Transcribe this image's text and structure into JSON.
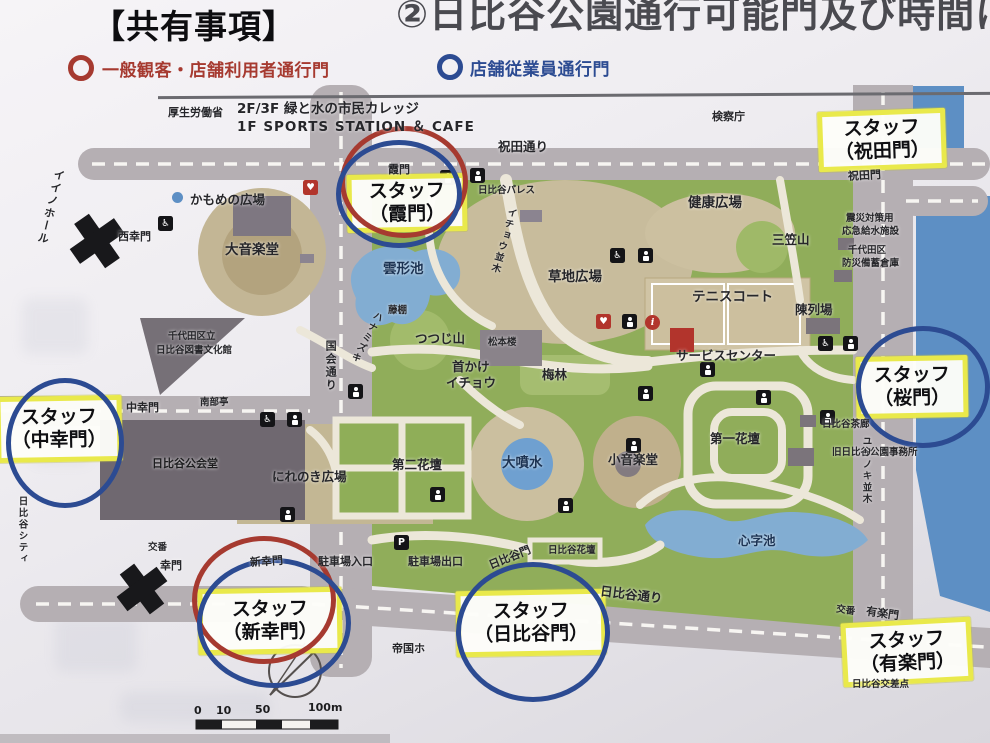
{
  "header": {
    "title_left": "【共有事項】",
    "title_right": "②日比谷公園通行可能門及び時間につ"
  },
  "legend": {
    "ring_colors": {
      "red": "#a63a30",
      "blue": "#2c4b92"
    },
    "items": [
      {
        "ring": "red",
        "label": "一般観客・店舗利用者通行門"
      },
      {
        "ring": "blue",
        "label": "店舗従業員通行門"
      }
    ]
  },
  "colors": {
    "highlight_yellow": "#e9e94b",
    "x_mark": "#18181b",
    "road_gray": "#b5afb3",
    "park_green": "#90ad5a",
    "water_blue": "#82add2"
  },
  "gate_access": [
    {
      "gate": "霞門",
      "marks": [
        "red",
        "blue"
      ]
    },
    {
      "gate": "祝田門",
      "marks": []
    },
    {
      "gate": "桜門",
      "marks": [
        "blue"
      ]
    },
    {
      "gate": "中幸門",
      "marks": [
        "blue"
      ]
    },
    {
      "gate": "新幸門",
      "marks": [
        "red",
        "blue"
      ]
    },
    {
      "gate": "日比谷門",
      "marks": [
        "blue"
      ]
    },
    {
      "gate": "有楽門",
      "marks": []
    },
    {
      "gate": "西幸門",
      "marks": [
        "x-closed"
      ]
    },
    {
      "gate": "幸門",
      "marks": [
        "x-closed"
      ]
    }
  ],
  "map": {
    "staff_labels": [
      {
        "line1": "スタッフ",
        "line2": "（霞門）"
      },
      {
        "line1": "スタッフ",
        "line2": "（祝田門）"
      },
      {
        "line1": "スタッフ",
        "line2": "（桜門）"
      },
      {
        "line1": "スタッフ",
        "line2": "（中幸門）"
      },
      {
        "line1": "スタッフ",
        "line2": "（新幸門）"
      },
      {
        "line1": "スタッフ",
        "line2": "（日比谷門）"
      },
      {
        "line1": "スタッフ",
        "line2": "（有楽門）"
      }
    ],
    "labels": [
      {
        "text": "厚生労働省"
      },
      {
        "text": "2F/3F 緑と水の市民カレッジ"
      },
      {
        "text": "1F SPORTS STATION ＆ CAFE"
      },
      {
        "text": "検察庁"
      },
      {
        "text": "祝田通り"
      },
      {
        "text": "祝田門"
      },
      {
        "text": "イイノホール"
      },
      {
        "text": "西幸門"
      },
      {
        "text": "かもめの広場"
      },
      {
        "text": "大音楽堂"
      },
      {
        "text": "雲形池"
      },
      {
        "text": "藤棚"
      },
      {
        "text": "日比谷パレス"
      },
      {
        "text": "健康広場"
      },
      {
        "text": "三笠山"
      },
      {
        "text": "震災対策用"
      },
      {
        "text": "応急給水施設"
      },
      {
        "text": "千代田区"
      },
      {
        "text": "防災備蓄倉庫"
      },
      {
        "text": "国会通り"
      },
      {
        "text": "千代田区立"
      },
      {
        "text": "日比谷図書文化館"
      },
      {
        "text": "イチョウ並木"
      },
      {
        "text": "ハナミズキ"
      },
      {
        "text": "つつじ山"
      },
      {
        "text": "松本楼"
      },
      {
        "text": "草地広場"
      },
      {
        "text": "首かけ"
      },
      {
        "text": "イチョウ"
      },
      {
        "text": "梅林"
      },
      {
        "text": "テニスコート"
      },
      {
        "text": "陳列場"
      },
      {
        "text": "サービスセンター"
      },
      {
        "text": "南部亭"
      },
      {
        "text": "第二花壇"
      },
      {
        "text": "大噴水"
      },
      {
        "text": "小音楽堂"
      },
      {
        "text": "第一花壇"
      },
      {
        "text": "日比谷茶廊"
      },
      {
        "text": "旧日比谷公園事務所"
      },
      {
        "text": "ユリノキ並木"
      },
      {
        "text": "日比谷公会堂"
      },
      {
        "text": "にれのき広場"
      },
      {
        "text": "心字池"
      },
      {
        "text": "日比谷花壇"
      },
      {
        "text": "駐車場入口"
      },
      {
        "text": "駐車場出口"
      },
      {
        "text": "日比谷門"
      },
      {
        "text": "交番"
      },
      {
        "text": "幸門"
      },
      {
        "text": "新幸門"
      },
      {
        "text": "日比谷シティ"
      },
      {
        "text": "日比谷通り"
      },
      {
        "text": "交番"
      },
      {
        "text": "有楽門"
      },
      {
        "text": "日比谷交差点"
      },
      {
        "text": "中幸門"
      },
      {
        "text": "霞門"
      },
      {
        "text": "帝国ホ"
      }
    ],
    "icons": {
      "accessible": "♿",
      "aed": "♥",
      "info": "i",
      "parking": "P"
    },
    "scale": {
      "ticks": [
        "0",
        "10",
        "50",
        "100m"
      ]
    }
  }
}
